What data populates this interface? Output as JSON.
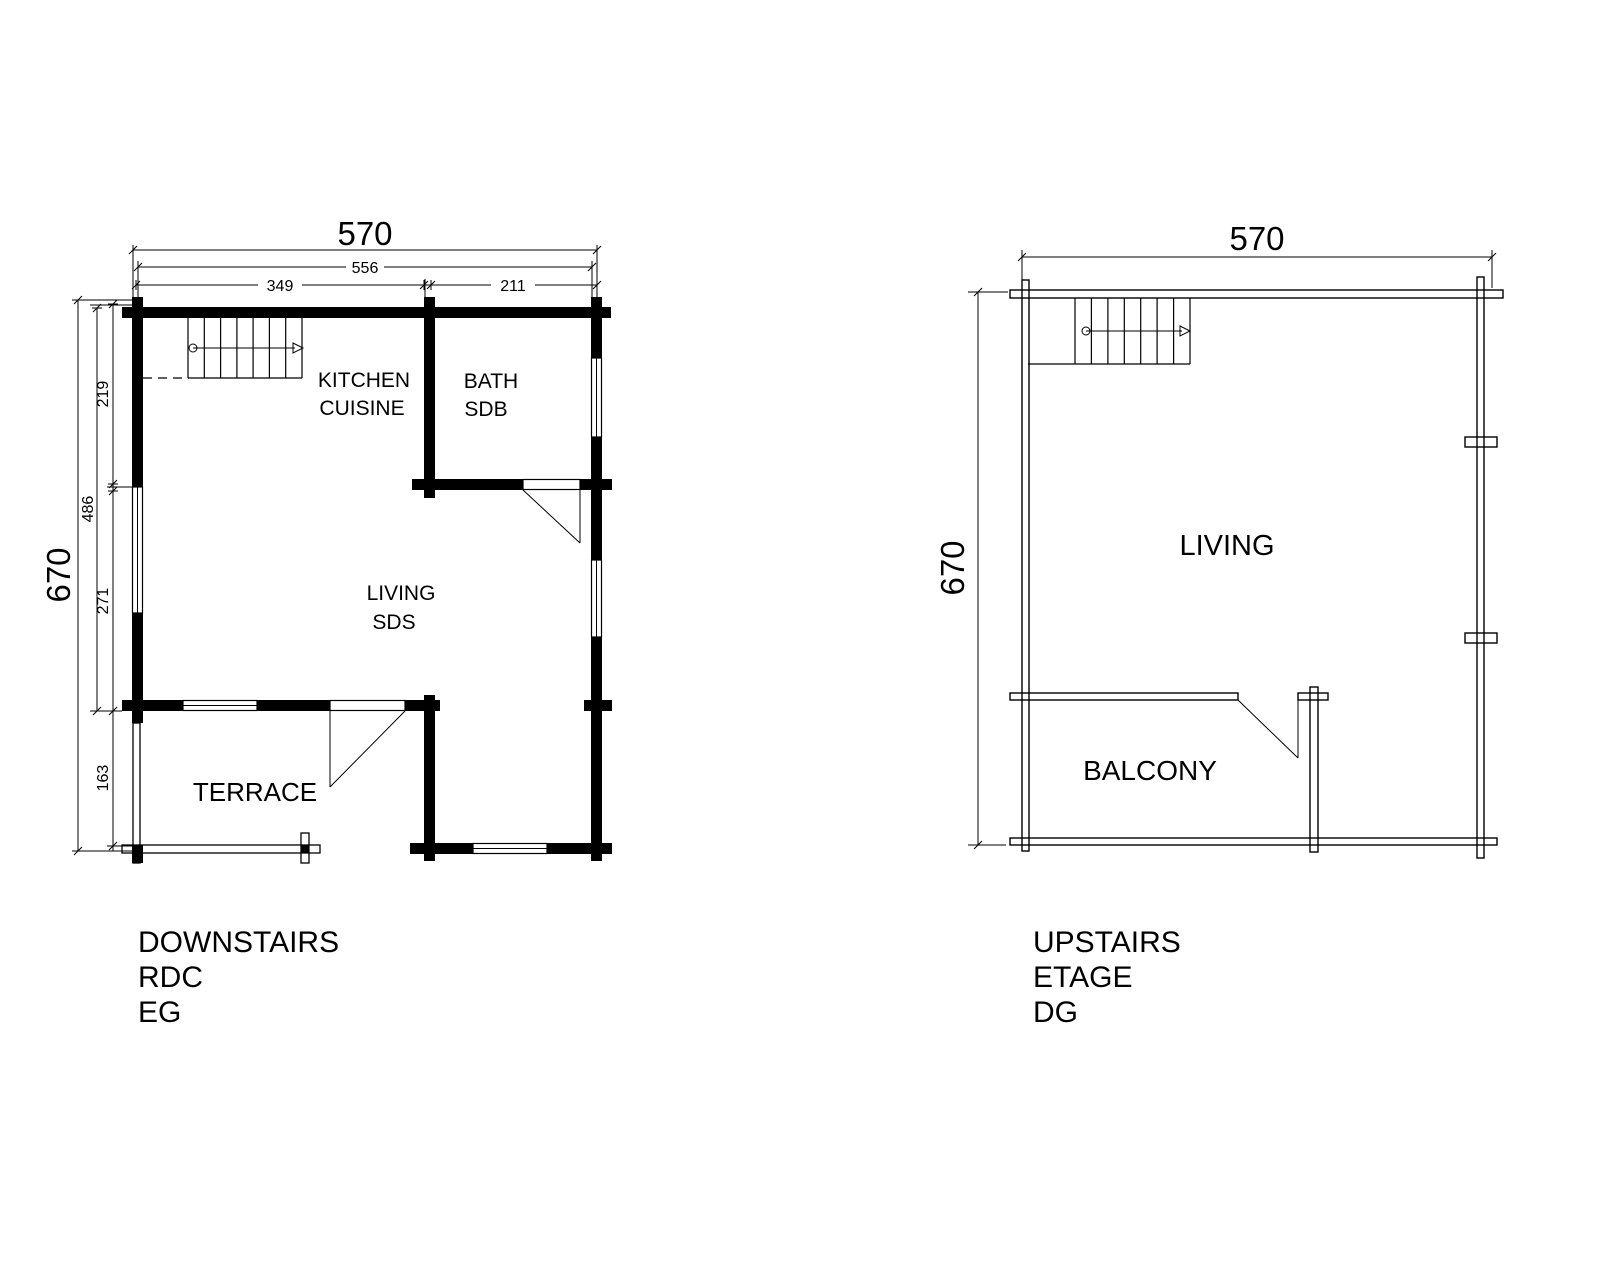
{
  "drawing": {
    "background_color": "#ffffff",
    "line_color": "#000000"
  },
  "downstairs": {
    "titles": [
      "DOWNSTAIRS",
      "RDC",
      "EG"
    ],
    "dims": {
      "total_width": "570",
      "inner_width": "556",
      "width_left": "349",
      "width_right": "211",
      "total_height": "670",
      "inner_height": "486",
      "height_top": "219",
      "height_mid": "271",
      "height_terrace": "163"
    },
    "rooms": {
      "kitchen_en": "KITCHEN",
      "kitchen_fr": "CUISINE",
      "bath_en": "BATH",
      "bath_fr": "SDB",
      "living_en": "LIVING",
      "living_fr": "SDS",
      "terrace": "TERRACE"
    }
  },
  "upstairs": {
    "titles": [
      "UPSTAIRS",
      "ETAGE",
      "DG"
    ],
    "dims": {
      "total_width": "570",
      "total_height": "670"
    },
    "rooms": {
      "living": "LIVING",
      "balcony": "BALCONY"
    }
  }
}
